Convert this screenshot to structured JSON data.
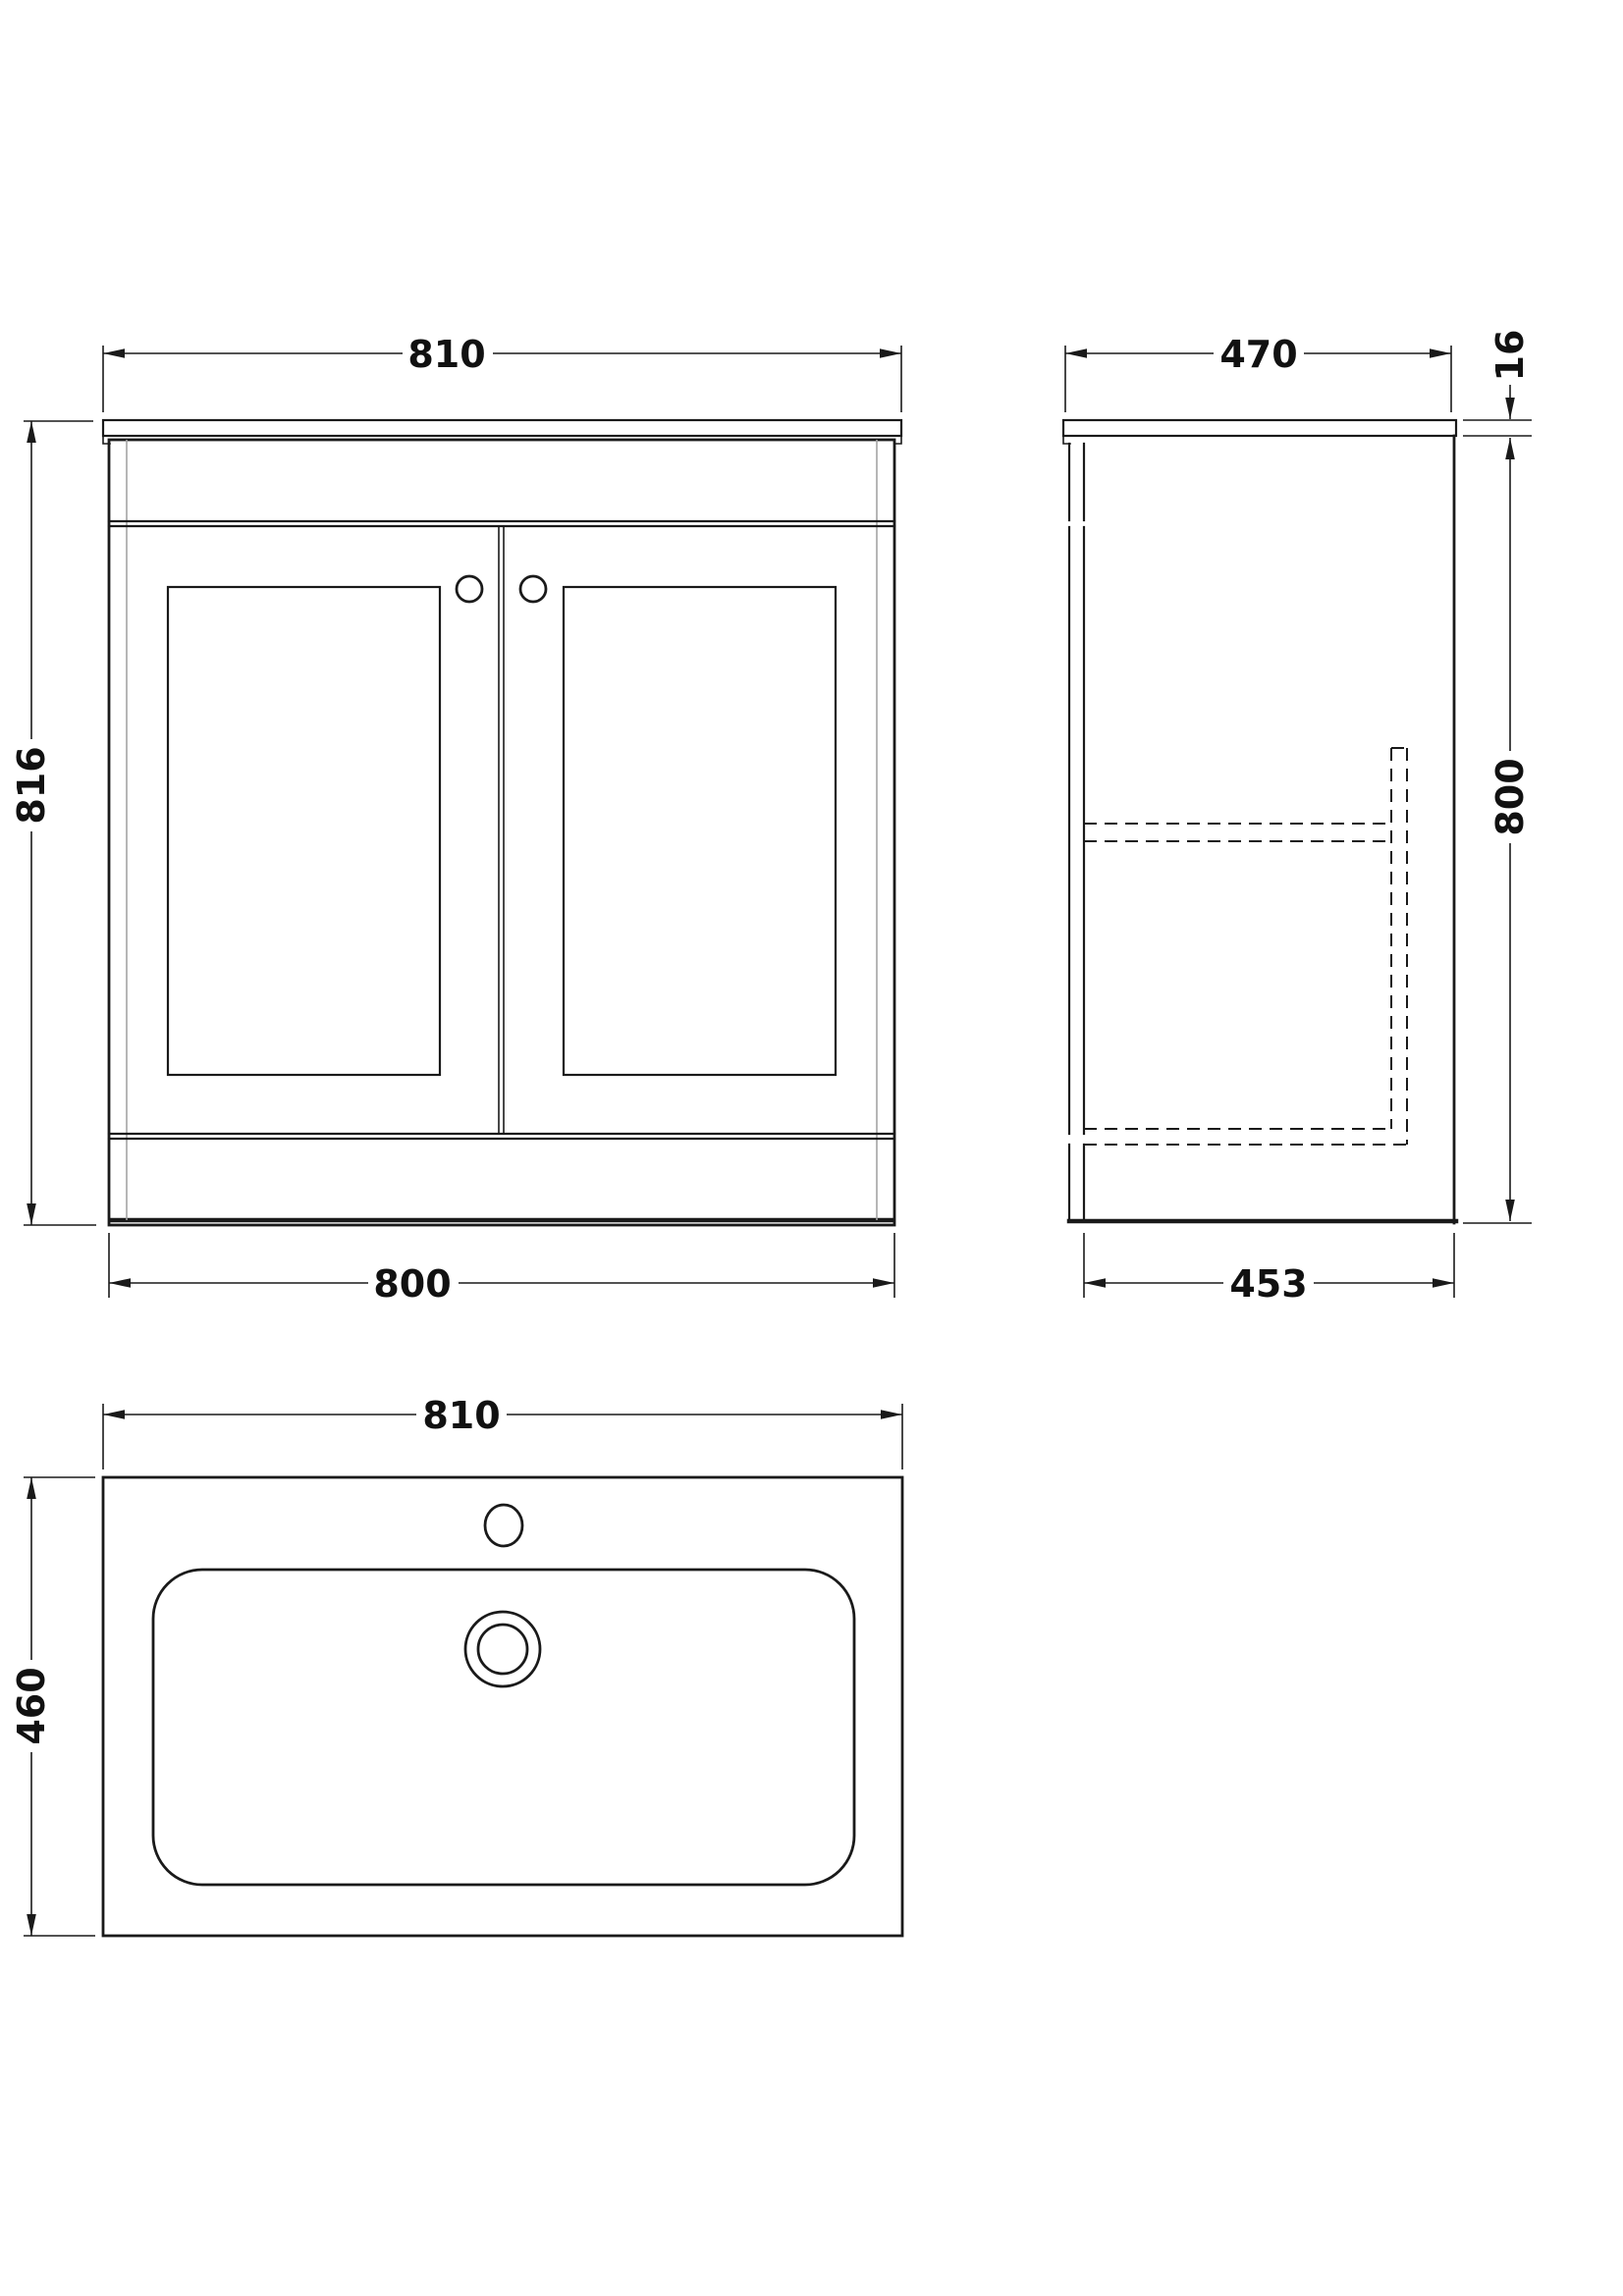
{
  "views": {
    "front": {
      "dims": {
        "width_top": "810",
        "height": "816",
        "width_bottom": "800"
      }
    },
    "side": {
      "dims": {
        "depth_top": "470",
        "worktop_thickness": "16",
        "height": "800",
        "depth_bottom": "453"
      }
    },
    "plan": {
      "dims": {
        "width": "810",
        "depth": "460"
      }
    }
  },
  "colors": {
    "line": "#1a1a1a",
    "inner_line": "#a3a3a3",
    "background": "#ffffff"
  }
}
